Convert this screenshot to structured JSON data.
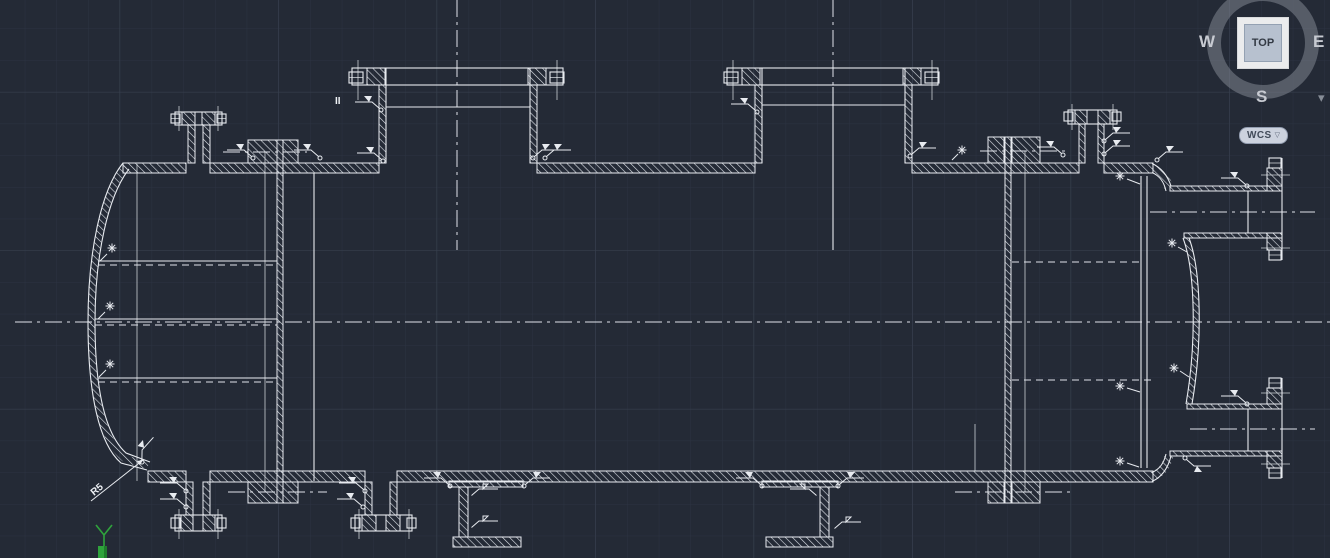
{
  "app": {
    "name": "cad-viewport",
    "view": "model-space"
  },
  "viewcube": {
    "west": "W",
    "east": "E",
    "south": "S",
    "top_face": "TOP",
    "menu_arrow": "▾"
  },
  "wcs_button": {
    "label": "WCS",
    "chevron": "▽"
  },
  "drawing": {
    "type": "pressure-vessel heat-exchanger longitudinal section",
    "radius_label": "R5",
    "seam_label": "II"
  },
  "colors": {
    "background": "#242a36",
    "grid_minor": "#2c3342",
    "grid_major": "#39414f",
    "line": "#e8ebf0",
    "ucs_green": "#2fa33c",
    "ucs_green_dark": "#1f7d2c",
    "viewcube_ring": "rgba(128,133,144,0.55)",
    "viewcube_face": "#ebeced",
    "viewcube_face_inner": "#b7c1cf",
    "wcs_bg": "#ccd2de"
  }
}
